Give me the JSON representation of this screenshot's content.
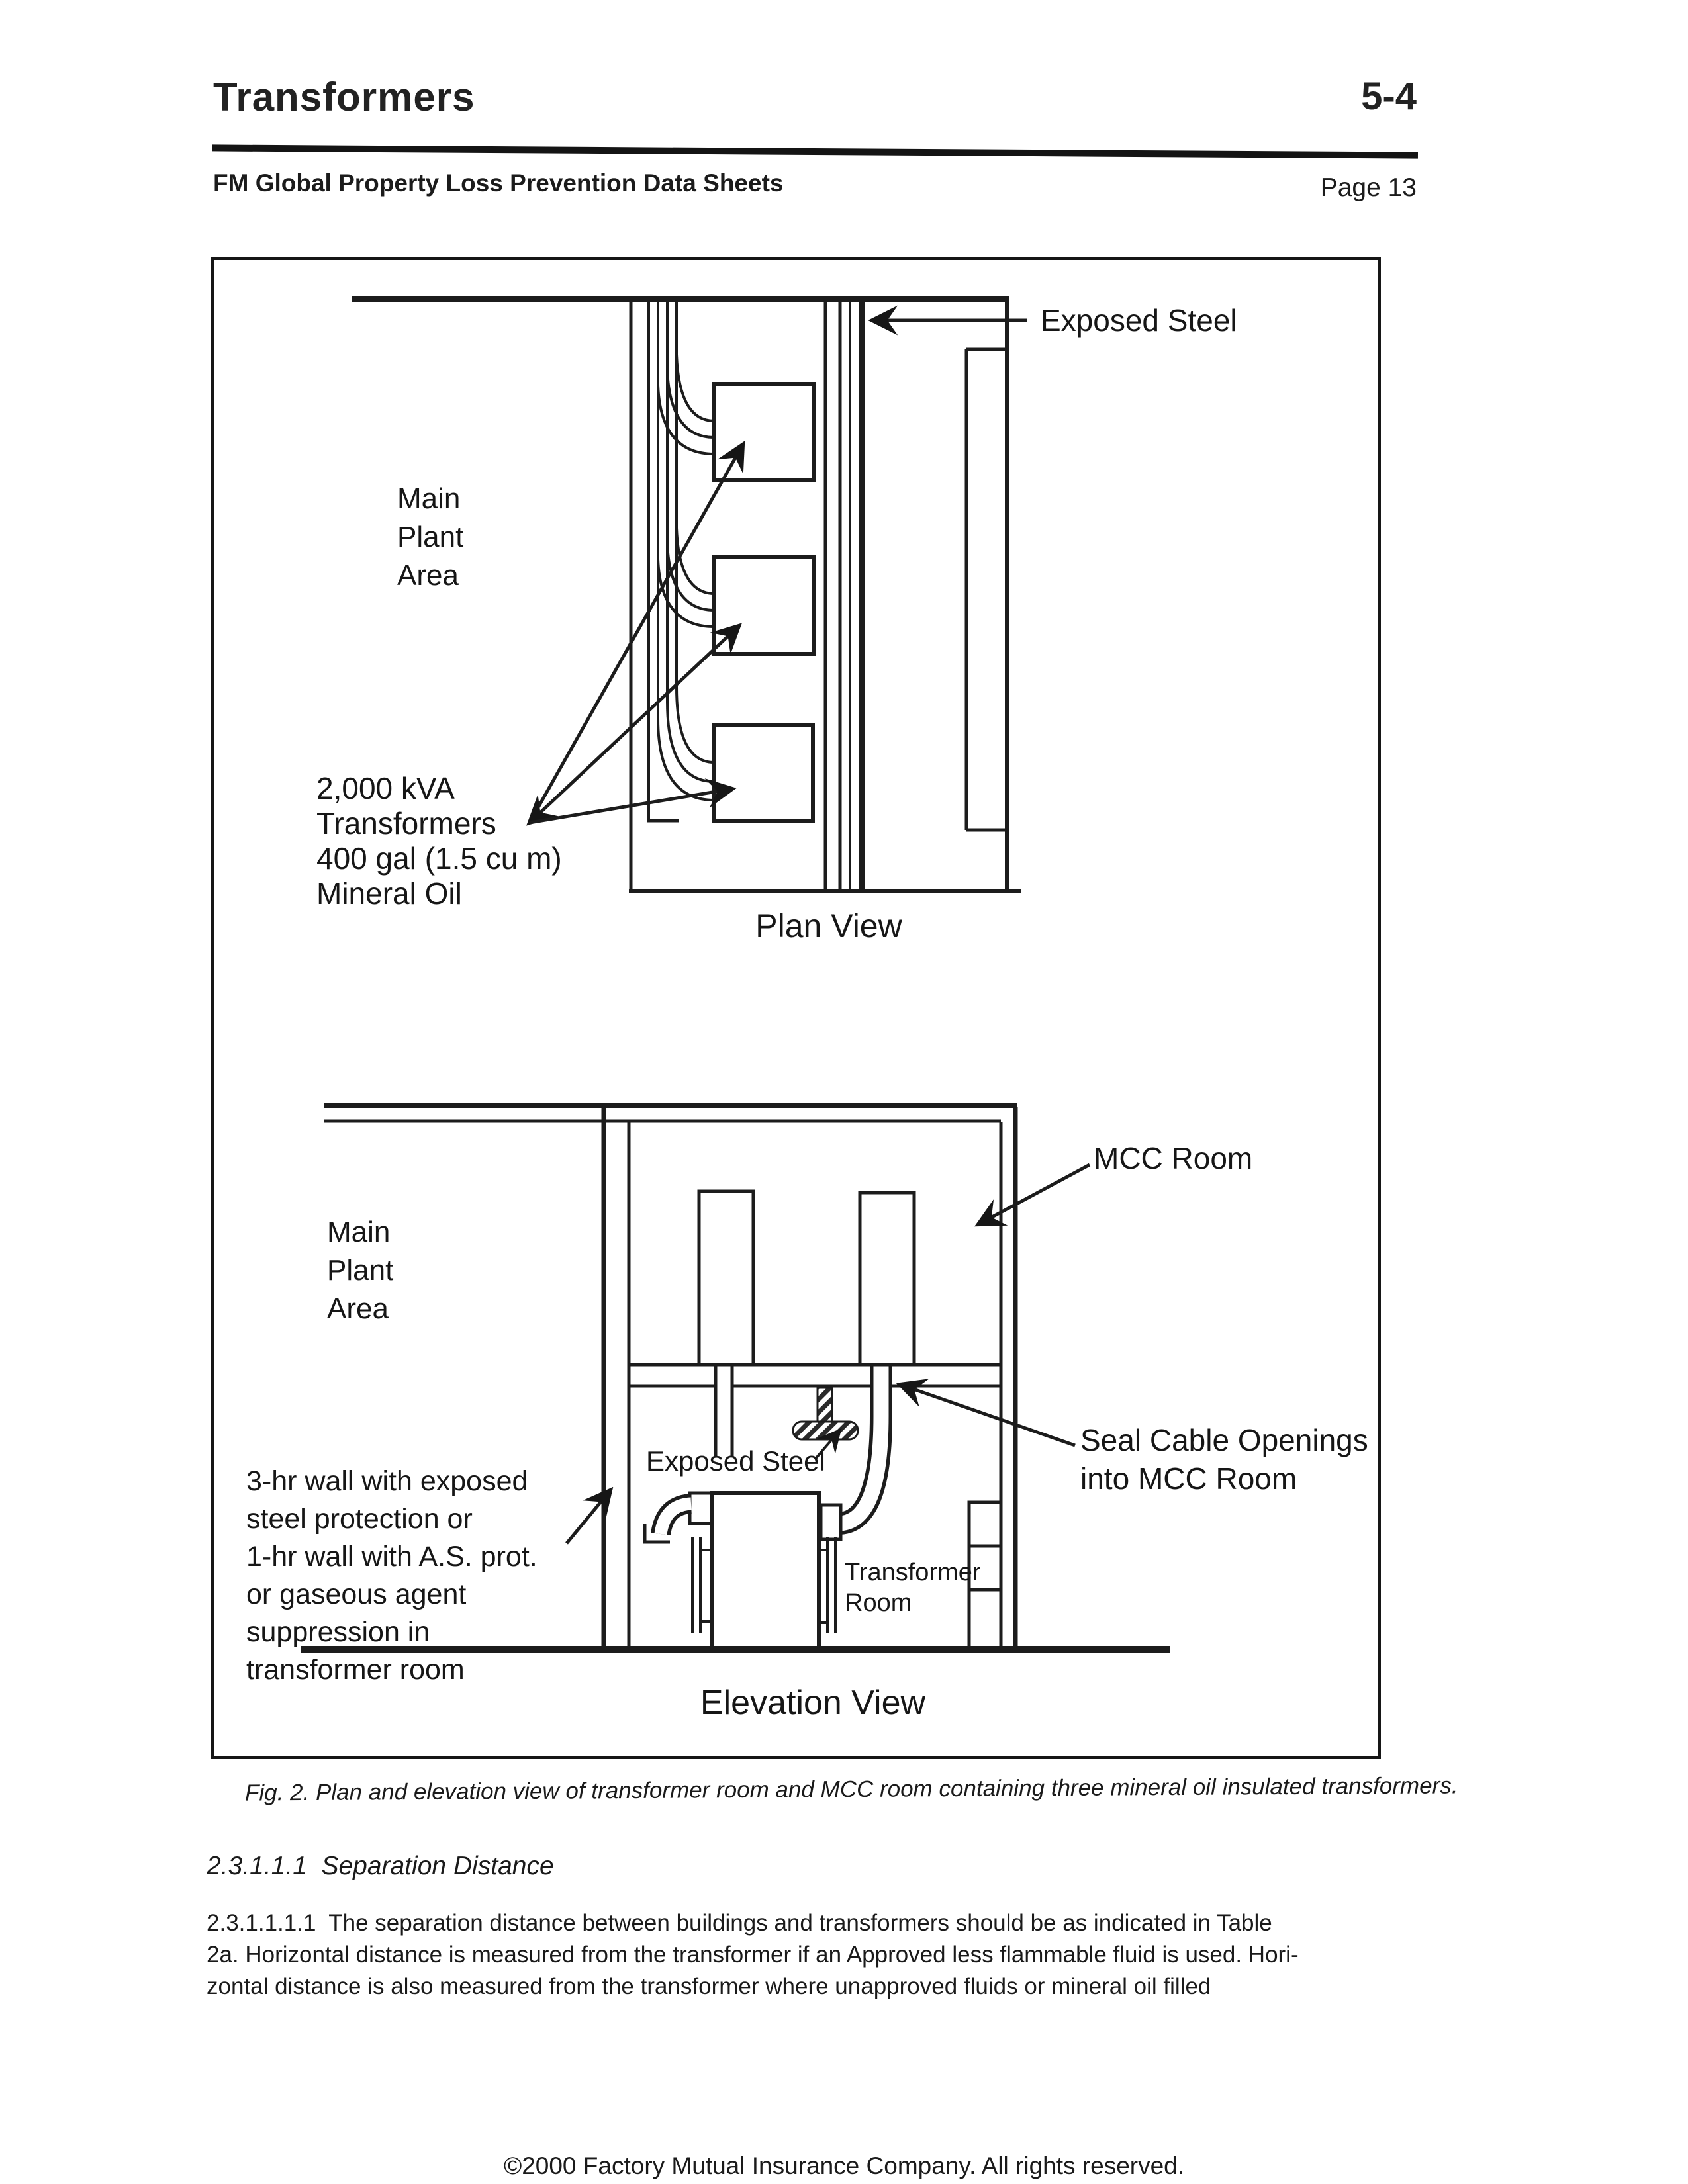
{
  "colors": {
    "ink": "#1a1a1a",
    "paper": "#ffffff"
  },
  "header": {
    "title": "Transformers",
    "code": "5-4",
    "subtitle": "FM Global Property Loss Prevention Data Sheets",
    "page": "Page 13"
  },
  "figure": {
    "plan": {
      "exposed_steel_label": "Exposed Steel",
      "main_plant_area_lines": [
        "Main",
        "Plant",
        "Area"
      ],
      "transformer_label_lines": [
        "2,000 kVA",
        "Transformers",
        "400 gal (1.5 cu m)",
        "Mineral Oil"
      ],
      "view_title": "Plan View"
    },
    "elevation": {
      "mcc_room_label": "MCC Room",
      "main_plant_area_lines": [
        "Main",
        "Plant",
        "Area"
      ],
      "wall_label_lines": [
        "3-hr wall with exposed",
        "steel protection or",
        "1-hr wall with A.S. prot.",
        "or gaseous agent",
        "suppression in",
        "transformer room"
      ],
      "exposed_steel_label": "Exposed Steel",
      "seal_label_lines": [
        "Seal Cable Openings",
        "into MCC Room"
      ],
      "transformer_room_label_lines": [
        "Transformer",
        "Room"
      ],
      "view_title": "Elevation View"
    },
    "caption": "Fig. 2. Plan and elevation view of transformer room and MCC room containing three mineral oil insulated transformers."
  },
  "body": {
    "section_heading": "2.3.1.1.1  Separation Distance",
    "paragraph_lines": [
      "2.3.1.1.1.1  The separation distance between buildings and transformers should be as indicated in Table",
      "2a. Horizontal distance is measured from the transformer if an Approved less flammable fluid is used. Hori-",
      "zontal distance is also measured from the transformer where unapproved fluids or mineral oil filled"
    ]
  },
  "footer": {
    "copyright": "©2000 Factory Mutual Insurance Company. All rights reserved."
  }
}
